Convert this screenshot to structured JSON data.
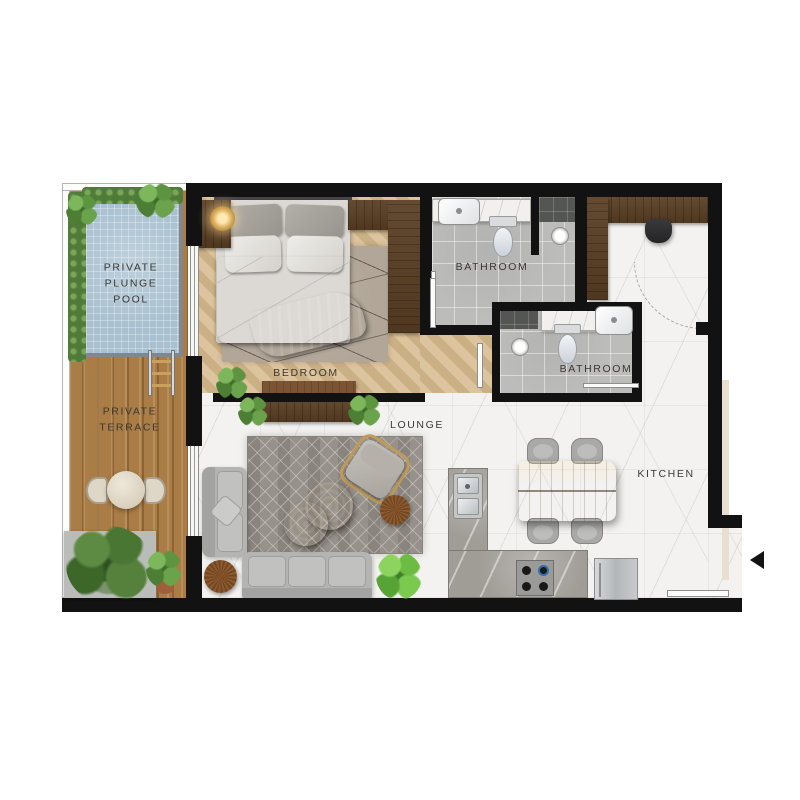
{
  "plan_title": "apartment-floor-plan",
  "labels": {
    "pool": "PRIVATE\nPLUNGE\nPOOL",
    "terrace": "PRIVATE\nTERRACE",
    "bedroom": "BEDROOM",
    "bathroom1": "BATHROOM",
    "bathroom2": "BATHROOM",
    "lounge": "LOUNGE",
    "kitchen": "KITCHEN"
  },
  "colors": {
    "wall": "#121212",
    "pool_water": "#a8c0d0",
    "deck_wood": "#a3763f",
    "bedroom_floor": "#d5bc95",
    "marble_floor": "#f3f2f0",
    "bathroom_tile": "#bcbcba",
    "dark_wood_furniture": "#5a3f24",
    "hedge_green": "#4f7a38",
    "sofa_gray": "#b4b4b2",
    "label_text": "#3c3833"
  }
}
